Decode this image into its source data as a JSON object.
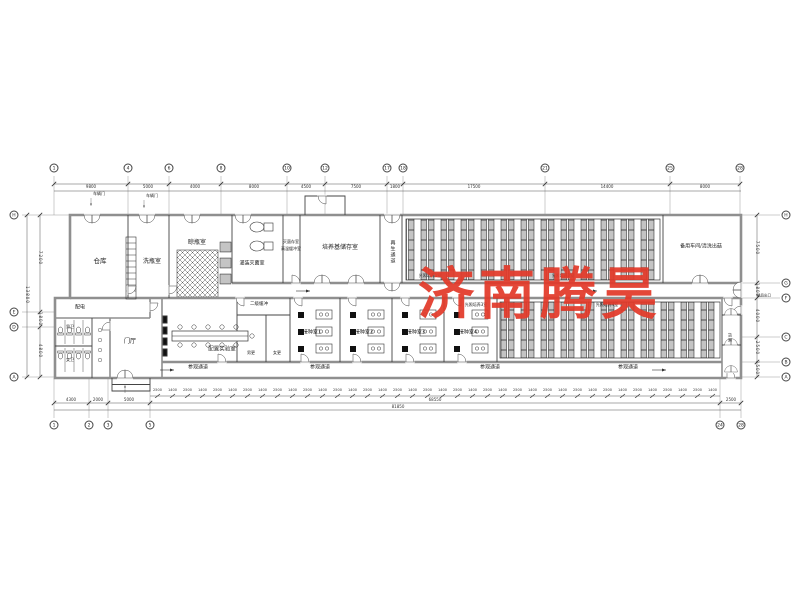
{
  "watermark": {
    "text": "济南腾昊",
    "color": "#e23a2a"
  },
  "grid_bubbles": [
    {
      "label": "1",
      "x": 54,
      "y": 168
    },
    {
      "label": "4",
      "x": 128,
      "y": 168
    },
    {
      "label": "6",
      "x": 169,
      "y": 168
    },
    {
      "label": "8",
      "x": 221,
      "y": 168
    },
    {
      "label": "10",
      "x": 287,
      "y": 168
    },
    {
      "label": "12",
      "x": 325,
      "y": 168
    },
    {
      "label": "17",
      "x": 387,
      "y": 168
    },
    {
      "label": "18",
      "x": 403,
      "y": 168
    },
    {
      "label": "21",
      "x": 545,
      "y": 168
    },
    {
      "label": "25",
      "x": 670,
      "y": 168
    },
    {
      "label": "28",
      "x": 740,
      "y": 168
    },
    {
      "label": "1",
      "x": 54,
      "y": 425
    },
    {
      "label": "2",
      "x": 89,
      "y": 425
    },
    {
      "label": "3",
      "x": 108,
      "y": 425
    },
    {
      "label": "5",
      "x": 150,
      "y": 425
    },
    {
      "label": "24",
      "x": 720,
      "y": 425
    },
    {
      "label": "28",
      "x": 741,
      "y": 425
    },
    {
      "label": "H",
      "x": 14,
      "y": 215
    },
    {
      "label": "E",
      "x": 14,
      "y": 312
    },
    {
      "label": "D",
      "x": 14,
      "y": 327
    },
    {
      "label": "A",
      "x": 14,
      "y": 377
    },
    {
      "label": "H",
      "x": 786,
      "y": 215
    },
    {
      "label": "G",
      "x": 786,
      "y": 283
    },
    {
      "label": "F",
      "x": 786,
      "y": 298
    },
    {
      "label": "C",
      "x": 786,
      "y": 337
    },
    {
      "label": "B",
      "x": 786,
      "y": 362
    },
    {
      "label": "A",
      "x": 786,
      "y": 377
    }
  ],
  "labels": [
    {
      "t": "仓库",
      "x": 100,
      "y": 261,
      "s": 6.5
    },
    {
      "t": "洗瓶室",
      "x": 152,
      "y": 262,
      "s": 6
    },
    {
      "t": "晾瓶室",
      "x": 197,
      "y": 243,
      "s": 6
    },
    {
      "t": "灌装灭菌室",
      "x": 252,
      "y": 264,
      "s": 5
    },
    {
      "t": "灭菌存室",
      "x": 291,
      "y": 242,
      "s": 4
    },
    {
      "t": "高温缓冲室",
      "x": 291,
      "y": 249,
      "s": 4
    },
    {
      "t": "培养基储存室",
      "x": 340,
      "y": 248,
      "s": 6
    },
    {
      "t": "再生通道",
      "x": 392,
      "y": 252,
      "s": 5,
      "v": 1
    },
    {
      "t": "备用车间/清洗出菇",
      "x": 701,
      "y": 247,
      "s": 5
    },
    {
      "t": "光照培养1室",
      "x": 430,
      "y": 276,
      "s": 4
    },
    {
      "t": "光照培养2室",
      "x": 563,
      "y": 276,
      "s": 4
    },
    {
      "t": "光照培养3室",
      "x": 476,
      "y": 305,
      "s": 4
    },
    {
      "t": "光照培养4室",
      "x": 607,
      "y": 305,
      "s": 4
    },
    {
      "t": "配电",
      "x": 80,
      "y": 308,
      "s": 5
    },
    {
      "t": "男卫",
      "x": 70,
      "y": 327,
      "s": 4
    },
    {
      "t": "女卫",
      "x": 70,
      "y": 360,
      "s": 4
    },
    {
      "t": "门厅",
      "x": 130,
      "y": 342,
      "s": 6
    },
    {
      "t": "配置实验室",
      "x": 222,
      "y": 350,
      "s": 5.5
    },
    {
      "t": "二级缓冲",
      "x": 259,
      "y": 305,
      "s": 4.5
    },
    {
      "t": "男更",
      "x": 251,
      "y": 353,
      "s": 4
    },
    {
      "t": "女更",
      "x": 277,
      "y": 353,
      "s": 4
    },
    {
      "t": "接种室1",
      "x": 312,
      "y": 333,
      "s": 5
    },
    {
      "t": "接种室2",
      "x": 364,
      "y": 333,
      "s": 5
    },
    {
      "t": "接种室3",
      "x": 416,
      "y": 333,
      "s": 5
    },
    {
      "t": "接种室4",
      "x": 468,
      "y": 333,
      "s": 5
    },
    {
      "t": "参观通道",
      "x": 198,
      "y": 368,
      "s": 5
    },
    {
      "t": "参观通道",
      "x": 320,
      "y": 368,
      "s": 5
    },
    {
      "t": "参观通道",
      "x": 490,
      "y": 368,
      "s": 5
    },
    {
      "t": "参观通道",
      "x": 628,
      "y": 368,
      "s": 5
    },
    {
      "t": "货淋",
      "x": 730,
      "y": 338,
      "s": 4,
      "v": 1
    },
    {
      "t": "车辆门",
      "x": 99,
      "y": 194,
      "s": 4
    },
    {
      "t": "车辆门",
      "x": 152,
      "y": 196,
      "s": 4
    },
    {
      "t": "成品出口",
      "x": 764,
      "y": 296,
      "s": 3.5
    }
  ],
  "dim_labels": [
    {
      "t": "9800",
      "x": 91,
      "y": 187,
      "s": 4
    },
    {
      "t": "5000",
      "x": 148,
      "y": 187,
      "s": 4
    },
    {
      "t": "4000",
      "x": 195,
      "y": 187,
      "s": 4
    },
    {
      "t": "8000",
      "x": 254,
      "y": 187,
      "s": 4
    },
    {
      "t": "4500",
      "x": 306,
      "y": 187,
      "s": 4
    },
    {
      "t": "7500",
      "x": 356,
      "y": 187,
      "s": 4
    },
    {
      "t": "1800",
      "x": 395,
      "y": 187,
      "s": 4
    },
    {
      "t": "17500",
      "x": 474,
      "y": 187,
      "s": 4
    },
    {
      "t": "14400",
      "x": 607,
      "y": 187,
      "s": 4
    },
    {
      "t": "8000",
      "x": 705,
      "y": 187,
      "s": 4
    },
    {
      "t": "4300",
      "x": 71,
      "y": 400,
      "s": 4
    },
    {
      "t": "2000",
      "x": 98,
      "y": 400,
      "s": 4
    },
    {
      "t": "5000",
      "x": 129,
      "y": 400,
      "s": 4
    },
    {
      "t": "68550",
      "x": 435,
      "y": 400,
      "s": 4
    },
    {
      "t": "2500",
      "x": 731,
      "y": 400,
      "s": 4
    },
    {
      "t": "81850",
      "x": 398,
      "y": 407,
      "s": 4
    },
    {
      "t": "7200",
      "x": 40,
      "y": 258,
      "s": 4,
      "v": 1
    },
    {
      "t": "1800",
      "x": 40,
      "y": 319,
      "s": 4,
      "v": 1
    },
    {
      "t": "4800",
      "x": 40,
      "y": 351,
      "s": 4,
      "v": 1
    },
    {
      "t": "13800",
      "x": 27,
      "y": 295,
      "s": 4,
      "v": 1
    },
    {
      "t": "7500",
      "x": 757,
      "y": 248,
      "s": 4,
      "v": 1
    },
    {
      "t": "1800",
      "x": 757,
      "y": 290,
      "s": 4,
      "v": 1
    },
    {
      "t": "4000",
      "x": 757,
      "y": 316,
      "s": 4,
      "v": 1
    },
    {
      "t": "2500",
      "x": 757,
      "y": 348,
      "s": 4,
      "v": 1
    },
    {
      "t": "1500",
      "x": 757,
      "y": 368,
      "s": 4,
      "v": 1
    }
  ],
  "dims": {
    "bottom_run": [
      "2500",
      "1400",
      "2500",
      "1400",
      "2500",
      "1400",
      "2500",
      "1400",
      "2500",
      "1400",
      "2500",
      "1400",
      "2500",
      "1400",
      "2500",
      "1400",
      "2500",
      "1400",
      "2500",
      "1400",
      "2500",
      "1400",
      "2500",
      "1400",
      "2500",
      "1400",
      "2500",
      "1400",
      "2500",
      "1400",
      "2500",
      "1400",
      "2500",
      "1400",
      "2500",
      "1400",
      "2500",
      "1400"
    ]
  }
}
